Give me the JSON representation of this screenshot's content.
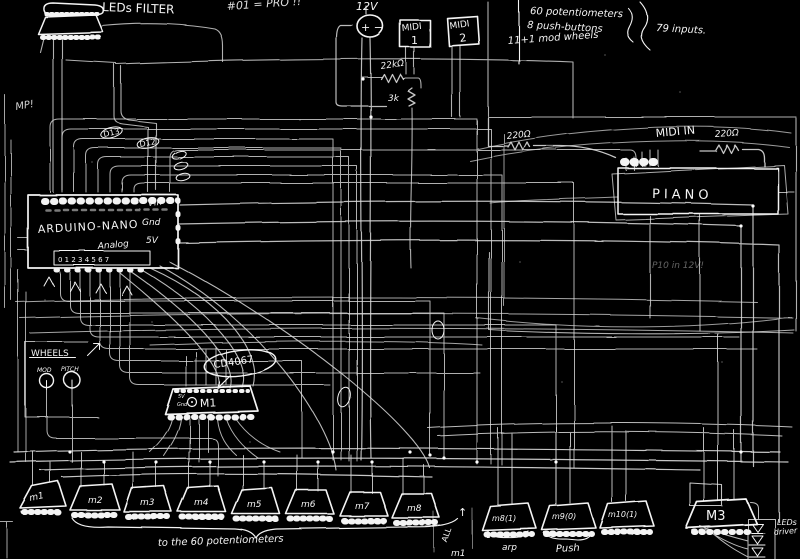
{
  "colors": {
    "background": "#000000",
    "ink": "#f2f2f2"
  },
  "notes": {
    "corner": "MP!",
    "equation": "#01 = PRO !!",
    "faint": "P10 in 12V!"
  },
  "leds_filter": {
    "label": "LEDs FILTER"
  },
  "power": {
    "label": "12V",
    "sign": "+ −"
  },
  "midi_ports": [
    {
      "name": "MIDI",
      "num": "1"
    },
    {
      "name": "MIDI",
      "num": "2"
    }
  ],
  "specs": {
    "items": [
      "60 potentiometers",
      "8 push-buttons",
      "11+1 mod wheels"
    ],
    "total": "79 inputs."
  },
  "resistors": {
    "r1": "22kΩ",
    "r2": "3k",
    "r3": "220Ω",
    "r4": "220Ω"
  },
  "piano": {
    "midi_in": "MIDI IN",
    "label": "PIANO"
  },
  "arduino": {
    "name": "ARDUINO-NANO",
    "vin": "Vin",
    "gnd": "Gnd",
    "v5": "5V",
    "analog": "Analog",
    "analog_pins": "0 1 2 3 4 5 6 7"
  },
  "wire_tags": {
    "t1": "D13",
    "t2": "D12"
  },
  "wheels": {
    "title": "WHEELS",
    "left": "MOD",
    "right": "PITCH"
  },
  "mux_main": {
    "chip": "CD4067",
    "label": "M1",
    "v5": "5V",
    "gnd": "Gnd"
  },
  "mux_row": {
    "labels": [
      "m1",
      "m2",
      "m3",
      "m4",
      "m5",
      "m6",
      "m7",
      "m8"
    ],
    "brace_label": "to the 60 potentiometers"
  },
  "button_muxes": {
    "labels": [
      "m8(1)",
      "m9(0)",
      "m10(1)"
    ],
    "groups": [
      "arp",
      "Push"
    ],
    "note_arrow": "↑",
    "note_text": "ALL",
    "note_sub": "m1"
  },
  "m3": {
    "label": "M3"
  },
  "led_driver": {
    "line1": "LEDs",
    "line2": "driver"
  }
}
